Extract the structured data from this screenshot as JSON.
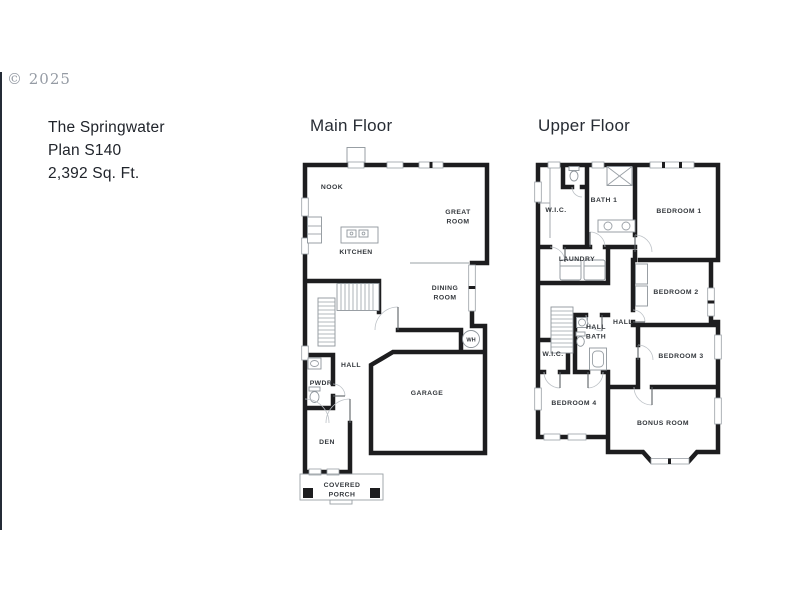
{
  "watermark": {
    "text": "© 2025"
  },
  "info": {
    "line1": "The Springwater",
    "line2": "Plan S140",
    "line3": "2,392 Sq. Ft."
  },
  "main_floor": {
    "title": "Main Floor",
    "labels": {
      "nook": "NOOK",
      "kitchen": "KITCHEN",
      "great1": "GREAT",
      "great2": "ROOM",
      "dining1": "DINING",
      "dining2": "ROOM",
      "hall": "HALL",
      "pwdr": "PWDR",
      "garage": "GARAGE",
      "den": "DEN",
      "porch1": "COVERED",
      "porch2": "PORCH",
      "wh": "WH"
    }
  },
  "upper_floor": {
    "title": "Upper Floor",
    "labels": {
      "wic1": "W.I.C.",
      "bath1": "BATH 1",
      "bedroom1": "BEDROOM 1",
      "laundry": "LAUNDRY",
      "bedroom2": "BEDROOM 2",
      "hall": "HALL",
      "hallbath1": "HALL",
      "hallbath2": "BATH",
      "wic2": "W.I.C.",
      "bedroom3": "BEDROOM 3",
      "bedroom4": "BEDROOM 4",
      "bonus": "BONUS ROOM"
    }
  },
  "colors": {
    "wall": "#1d1d1f",
    "thin_line": "#9aa0a6",
    "label_text": "#33373c",
    "heading_text": "#272c34",
    "watermark_gray": "#959ba4"
  }
}
